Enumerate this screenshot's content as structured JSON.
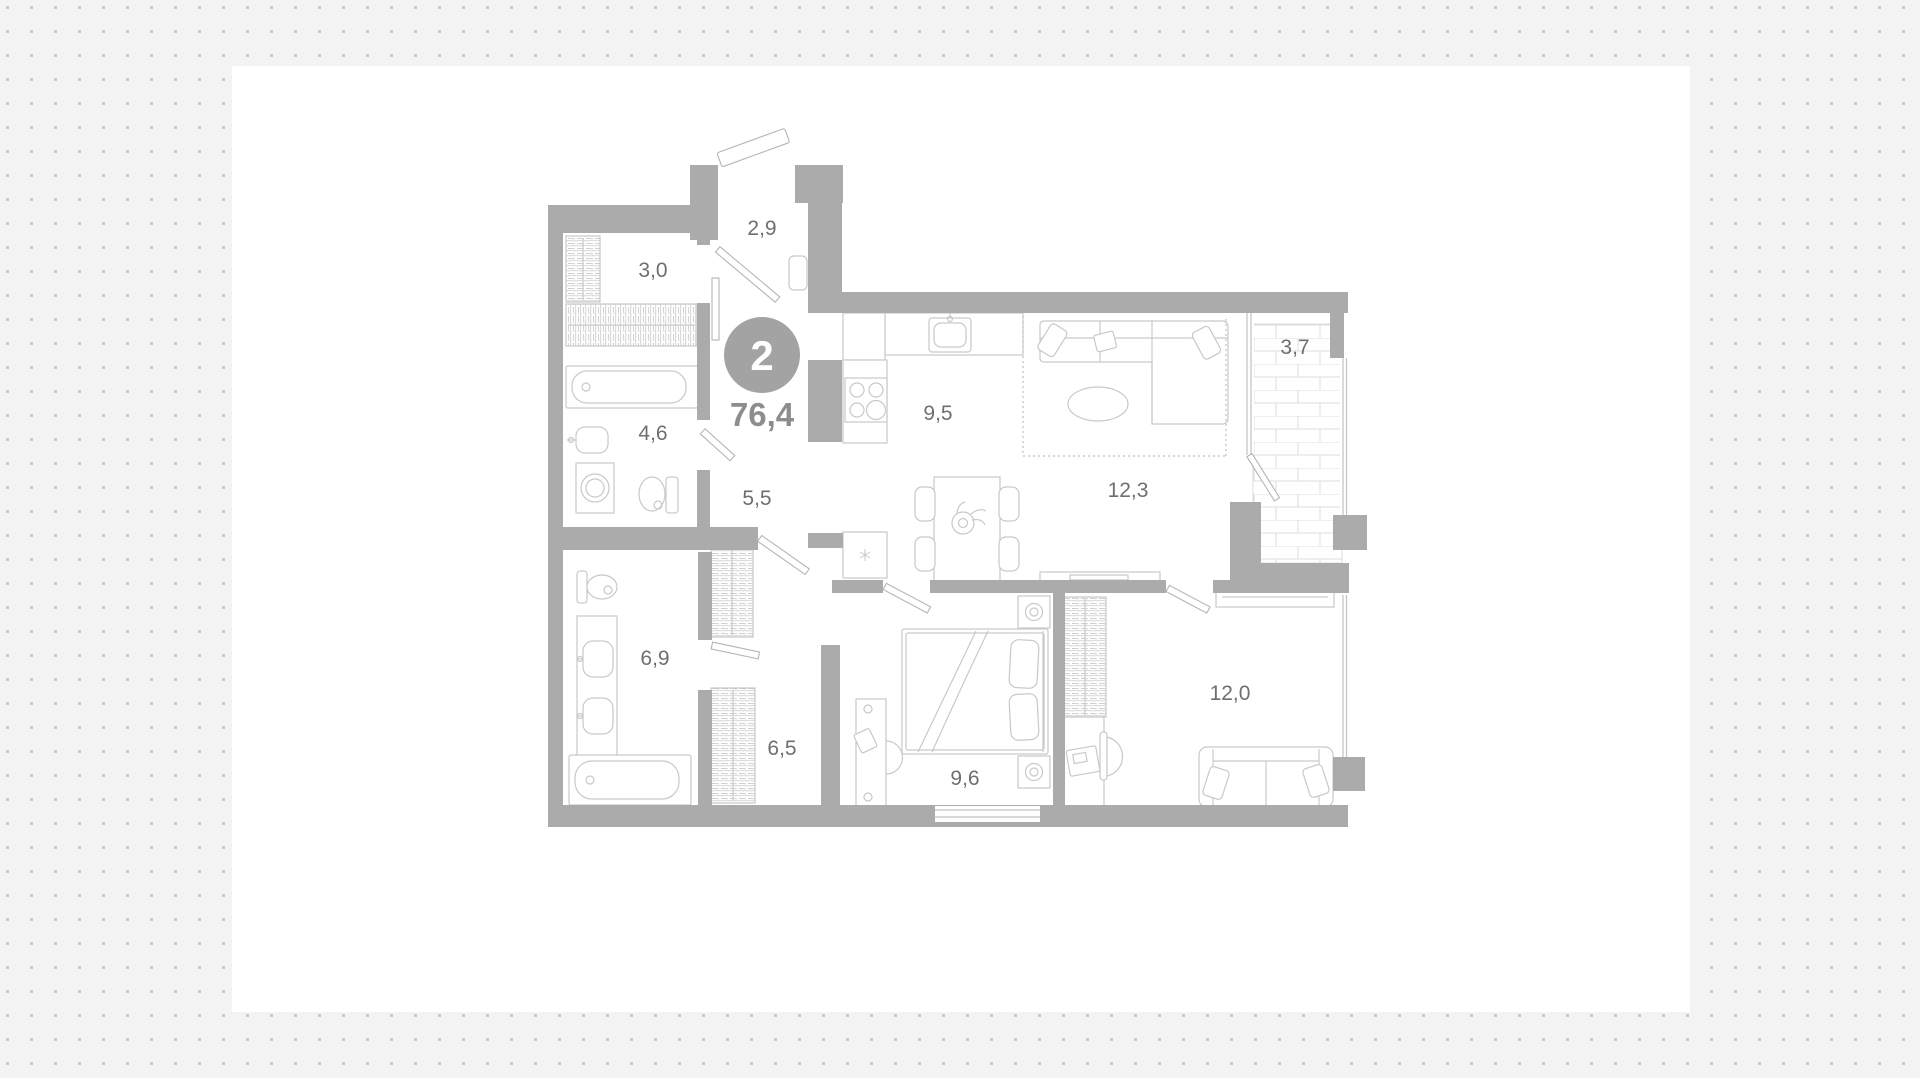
{
  "plan": {
    "badge": {
      "rooms_count": "2",
      "total_area": "76,4"
    },
    "rooms": [
      {
        "name": "entry-hall",
        "area": "2,9"
      },
      {
        "name": "closet",
        "area": "3,0"
      },
      {
        "name": "bathroom-small",
        "area": "4,6"
      },
      {
        "name": "hallway",
        "area": "5,5"
      },
      {
        "name": "kitchen",
        "area": "9,5"
      },
      {
        "name": "living-room",
        "area": "12,3"
      },
      {
        "name": "balcony",
        "area": "3,7"
      },
      {
        "name": "bathroom-large",
        "area": "6,9"
      },
      {
        "name": "corridor",
        "area": "6,5"
      },
      {
        "name": "bedroom",
        "area": "9,6"
      },
      {
        "name": "second-room",
        "area": "12,0"
      }
    ],
    "colors": {
      "background": "#f3f3f3",
      "dot": "#c9c9c9",
      "card": "#ffffff",
      "wall": "#ababab",
      "furniture_line": "#c6c9cc",
      "label_text": "#6f6f6f",
      "badge_circle": "#a3a3a3",
      "badge_text": "#ffffff",
      "total_area_text": "#8d8d8d"
    }
  }
}
